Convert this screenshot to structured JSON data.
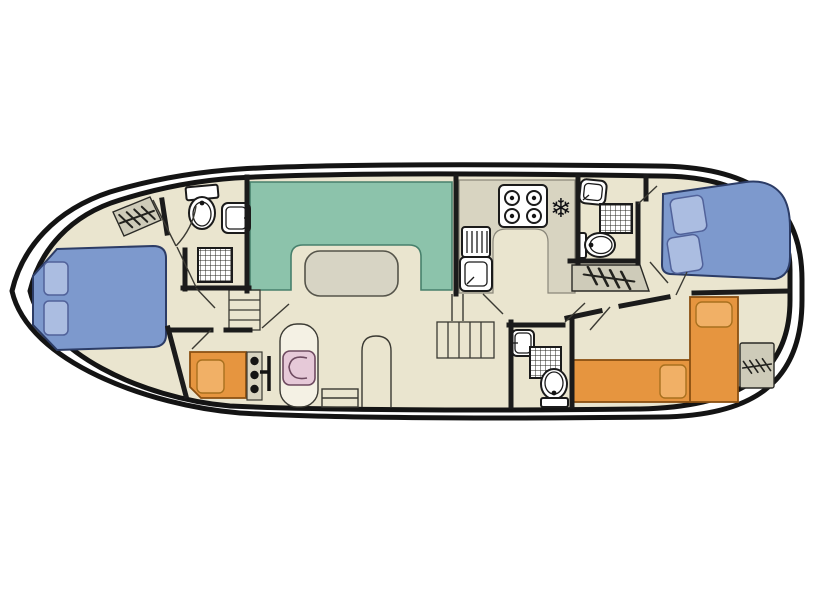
{
  "figure": {
    "type": "boat-deck-floor-plan",
    "orientation": "bow-left-stern-right"
  },
  "colors": {
    "background": "#ffffff",
    "hull_fill": "#ffffff",
    "hull_stroke": "#141414",
    "deck_fill": "#eae5cf",
    "wall": "#1b1b1b",
    "saloon_bench": "#8cc3ab",
    "table": "#d7d4c4",
    "galley_counter": "#d8d4c1",
    "double_bed": "#7d99cd",
    "pillow_blue": "#abbde1",
    "single_bed": "#e6953f",
    "pillow_orange": "#f1b066",
    "helm_chair_pink": "#e6c9d8",
    "helm_pad": "#f4f1e4",
    "stairs_gray": "#cecbb9",
    "fixture_white": "#ffffff",
    "glyph_dark": "#101014"
  },
  "icons": {
    "freezer": "❄"
  },
  "rooms": [
    {
      "name": "bow-double-cabin",
      "furniture": [
        "double-bed",
        "pillow",
        "pillow"
      ]
    },
    {
      "name": "bow-bathroom",
      "furniture": [
        "toilet",
        "sink",
        "shower"
      ]
    },
    {
      "name": "saloon",
      "furniture": [
        "u-shaped-bench",
        "table"
      ]
    },
    {
      "name": "galley",
      "furniture": [
        "counter",
        "stove-4-burners",
        "freezer",
        "sink-with-drainer"
      ]
    },
    {
      "name": "wheelhouse",
      "furniture": [
        "helm-console",
        "steering-wheel",
        "helm-chair",
        "single-bed",
        "bench",
        "chair"
      ]
    },
    {
      "name": "mid-bathroom",
      "furniture": [
        "toilet",
        "sink",
        "shower"
      ]
    },
    {
      "name": "aft-bathroom",
      "furniture": [
        "toilet",
        "sink",
        "shower"
      ]
    },
    {
      "name": "aft-double-cabin",
      "furniture": [
        "double-bed",
        "pillow",
        "pillow"
      ]
    },
    {
      "name": "aft-twin-cabin",
      "furniture": [
        "single-bed",
        "single-bed",
        "pillow",
        "pillow"
      ]
    }
  ],
  "stairs_count": 6
}
